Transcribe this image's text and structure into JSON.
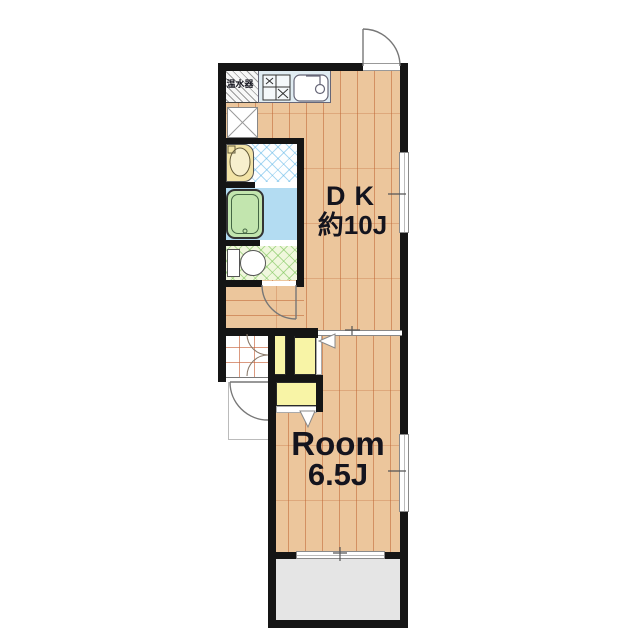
{
  "title": "1DK apartment floor plan",
  "labels": {
    "water_heater": "温水器",
    "dk": "DK",
    "dk_size": "約10J",
    "room": "Room",
    "room_size": "6.5J"
  },
  "rooms": [
    {
      "name": "dining-kitchen",
      "label_text": "DK 約10J",
      "floor": "wood"
    },
    {
      "name": "western-room",
      "label_text": "Room 6.5J",
      "floor": "wood"
    },
    {
      "name": "washbasin-room",
      "floor": "blue-crosshatch-tile"
    },
    {
      "name": "bathroom",
      "floor": "light-blue"
    },
    {
      "name": "toilet-room",
      "floor": "green-crosshatch-tile"
    },
    {
      "name": "entrance-genkan",
      "floor": "orange-grid-tile"
    },
    {
      "name": "hallway",
      "floor": "wood"
    },
    {
      "name": "balcony",
      "floor": "gray"
    }
  ],
  "fixtures": [
    "water-heater",
    "gas-stove",
    "kitchen-sink",
    "washing-machine-space",
    "washbasin-vanity",
    "bathtub",
    "toilet",
    "closet-upper-left",
    "closet-upper-right",
    "closet-lower",
    "entrance-door",
    "porch-door",
    "interior-door",
    "sliding-partition",
    "dk-window",
    "room-window",
    "balcony-window"
  ],
  "colors": {
    "wall": "#151515",
    "wood_floor": "#ecc69c",
    "wood_seam": "#c1703d",
    "bath_floor": "#b3dcf2",
    "bathtub": "#c2e5ae",
    "toilet_floor_tint": "#f0f7dd",
    "washbasin_floor_tint": "#fdfeff",
    "closet": "#f8f4a6",
    "kitchen_counter": "#e0ecf2",
    "balcony": "#e5e5e5",
    "genkan_tile_line": "#cc6a44",
    "vanity": "#f2e3a6",
    "label_text": "#14141e"
  }
}
